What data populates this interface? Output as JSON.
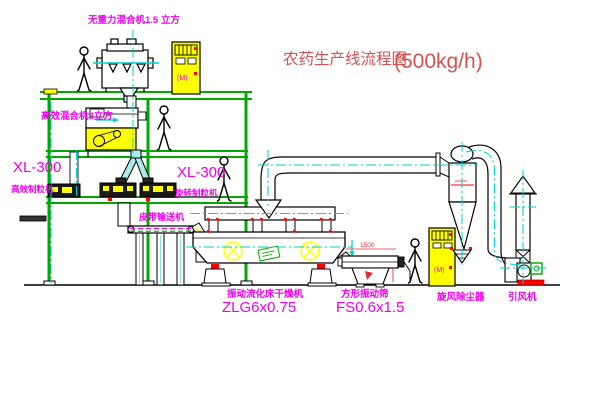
{
  "title": {
    "cn": "农药生产线流程图",
    "capacity": "(500kg/h)"
  },
  "colors": {
    "structure_green": "#00a800",
    "centerline_cyan": "#00cfcf",
    "label_magenta": "#ee00ee",
    "title_red": "#d85151",
    "machine_yellow": "#ffff00",
    "accent_red": "#ff0000"
  },
  "labels": {
    "gravity_mixer": "无重力混合机1.5 立方",
    "efficient_mixer": "高效混合机3立方",
    "left_granulator_model": "XL-300",
    "left_granulator_name": "高效制粒机",
    "mid_granulator_model": "XL-300",
    "mid_granulator_name": "旋转制粒机",
    "belt_conveyor": "皮带输送机",
    "dryer_name": "振动流化床干燥机",
    "dryer_model": "ZLG6x0.75",
    "screen_name": "方形振动筛",
    "screen_model": "FS0.6x1.5",
    "cyclone_name": "旋风除尘器",
    "fan_name": "引风机",
    "dim_1500": "1500",
    "cabinet_indicator": "(M)"
  }
}
